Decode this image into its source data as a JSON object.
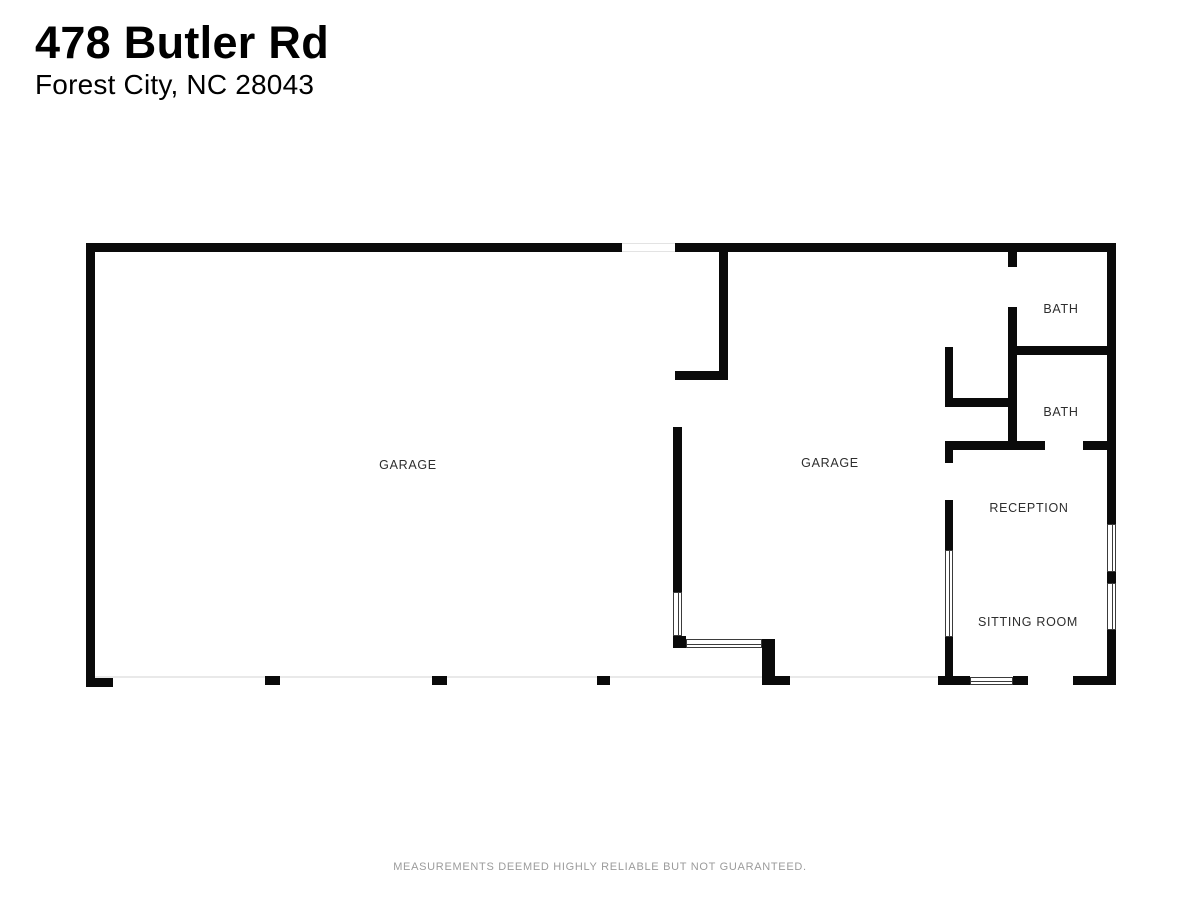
{
  "header": {
    "address_line1": "478 Butler Rd",
    "address_line2": "Forest City, NC 28043"
  },
  "floor_plan": {
    "wall_color": "#0a0a0a",
    "rooms": [
      {
        "id": "garage-left",
        "label": "GARAGE"
      },
      {
        "id": "garage-right",
        "label": "GARAGE"
      },
      {
        "id": "bath-1",
        "label": "BATH"
      },
      {
        "id": "bath-2",
        "label": "BATH"
      },
      {
        "id": "reception",
        "label": "RECEPTION"
      },
      {
        "id": "sitting-room",
        "label": "SITTING ROOM"
      }
    ]
  },
  "footer": {
    "disclaimer": "MEASUREMENTS DEEMED HIGHLY RELIABLE BUT NOT GUARANTEED."
  }
}
